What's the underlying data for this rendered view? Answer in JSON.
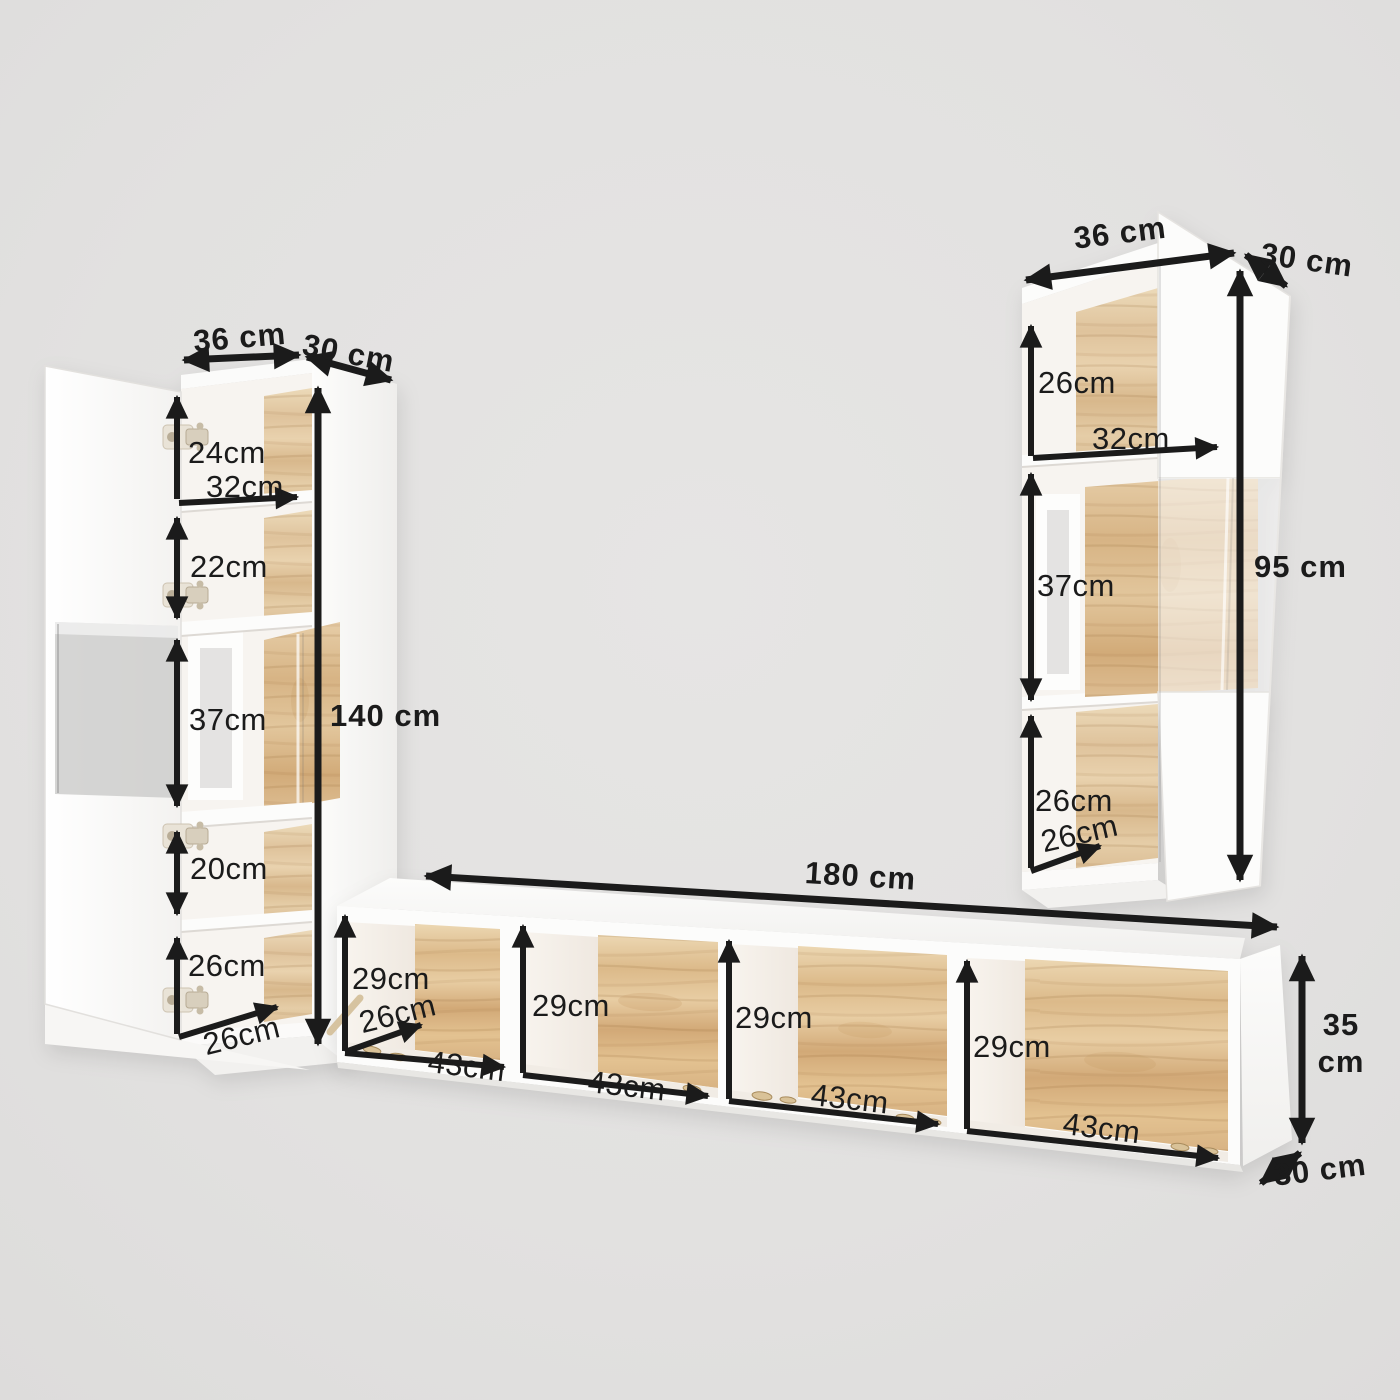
{
  "scene": {
    "background_color": "#e3e2e1",
    "arrow_color": "#1b1b1b",
    "furniture_white": "#fcfcfb",
    "wood_cabinet_color": "#e2c69c",
    "wood_tv_color": "#ddba8a"
  },
  "left_cabinet": {
    "width_label": "36 cm",
    "depth_label": "30 cm",
    "height_label": "140 cm",
    "inner_width_label": "32cm",
    "inner_depth_label": "26cm",
    "compartments": [
      {
        "label": "24cm"
      },
      {
        "label": "22cm"
      },
      {
        "label": "37cm"
      },
      {
        "label": "20cm"
      },
      {
        "label": "26cm"
      }
    ]
  },
  "right_cabinet": {
    "width_label": "36 cm",
    "depth_label": "30 cm",
    "height_label": "95 cm",
    "inner_width_label": "32cm",
    "inner_depth_label": "26cm",
    "compartments": [
      {
        "label": "26cm"
      },
      {
        "label": "37cm"
      },
      {
        "label": "26cm"
      }
    ]
  },
  "tv_stand": {
    "width_label": "180 cm",
    "depth_label": "30 cm",
    "height_label_lines": [
      "35",
      "cm"
    ],
    "inner_depth_label": "26cm",
    "compartments": [
      {
        "height_label": "29cm",
        "width_label": "43cm"
      },
      {
        "height_label": "29cm",
        "width_label": "43cm"
      },
      {
        "height_label": "29cm",
        "width_label": "43cm"
      },
      {
        "height_label": "29cm",
        "width_label": "43cm"
      }
    ]
  }
}
